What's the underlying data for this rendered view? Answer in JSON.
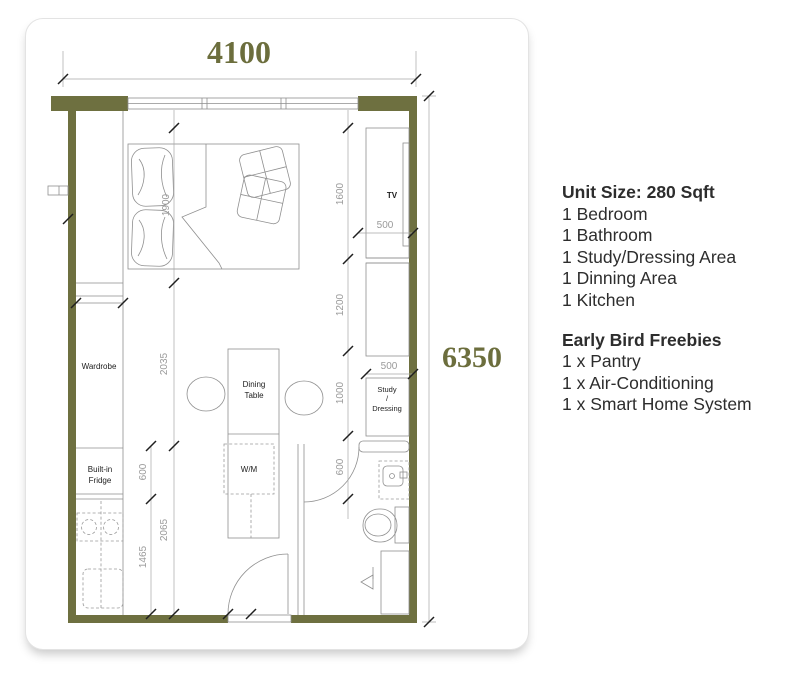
{
  "plan": {
    "width_label": "4100",
    "height_label": "6350",
    "dims": {
      "bed": "1900",
      "left_mid": "2035",
      "left_low": "2065",
      "wm": "600",
      "kitchen": "1465",
      "tv": "1600",
      "mid": "1200",
      "study": "1000",
      "bath": "600",
      "tv_depth": "500",
      "study_depth": "500"
    },
    "labels": {
      "wardrobe": "Wardrobe",
      "fridge_1": "Built-in",
      "fridge_2": "Fridge",
      "dining_1": "Dining",
      "dining_2": "Table",
      "wm": "W/M",
      "tv": "TV",
      "study_1": "Study",
      "study_2": "/",
      "study_3": "Dressing"
    }
  },
  "info": {
    "unit_size": "Unit Size: 280 Sqft",
    "features": [
      "1 Bedroom",
      "1 Bathroom",
      "1 Study/Dressing Area",
      "1 Dinning Area",
      "1 Kitchen"
    ],
    "freebies_title": "Early Bird Freebies",
    "freebies": [
      "1 x Pantry",
      "1 x Air-Conditioning",
      "1 x Smart Home System"
    ]
  },
  "colors": {
    "wall": "#6e7040",
    "dimension_text": "#6c6e3d",
    "body_text": "#2d2d2d"
  }
}
